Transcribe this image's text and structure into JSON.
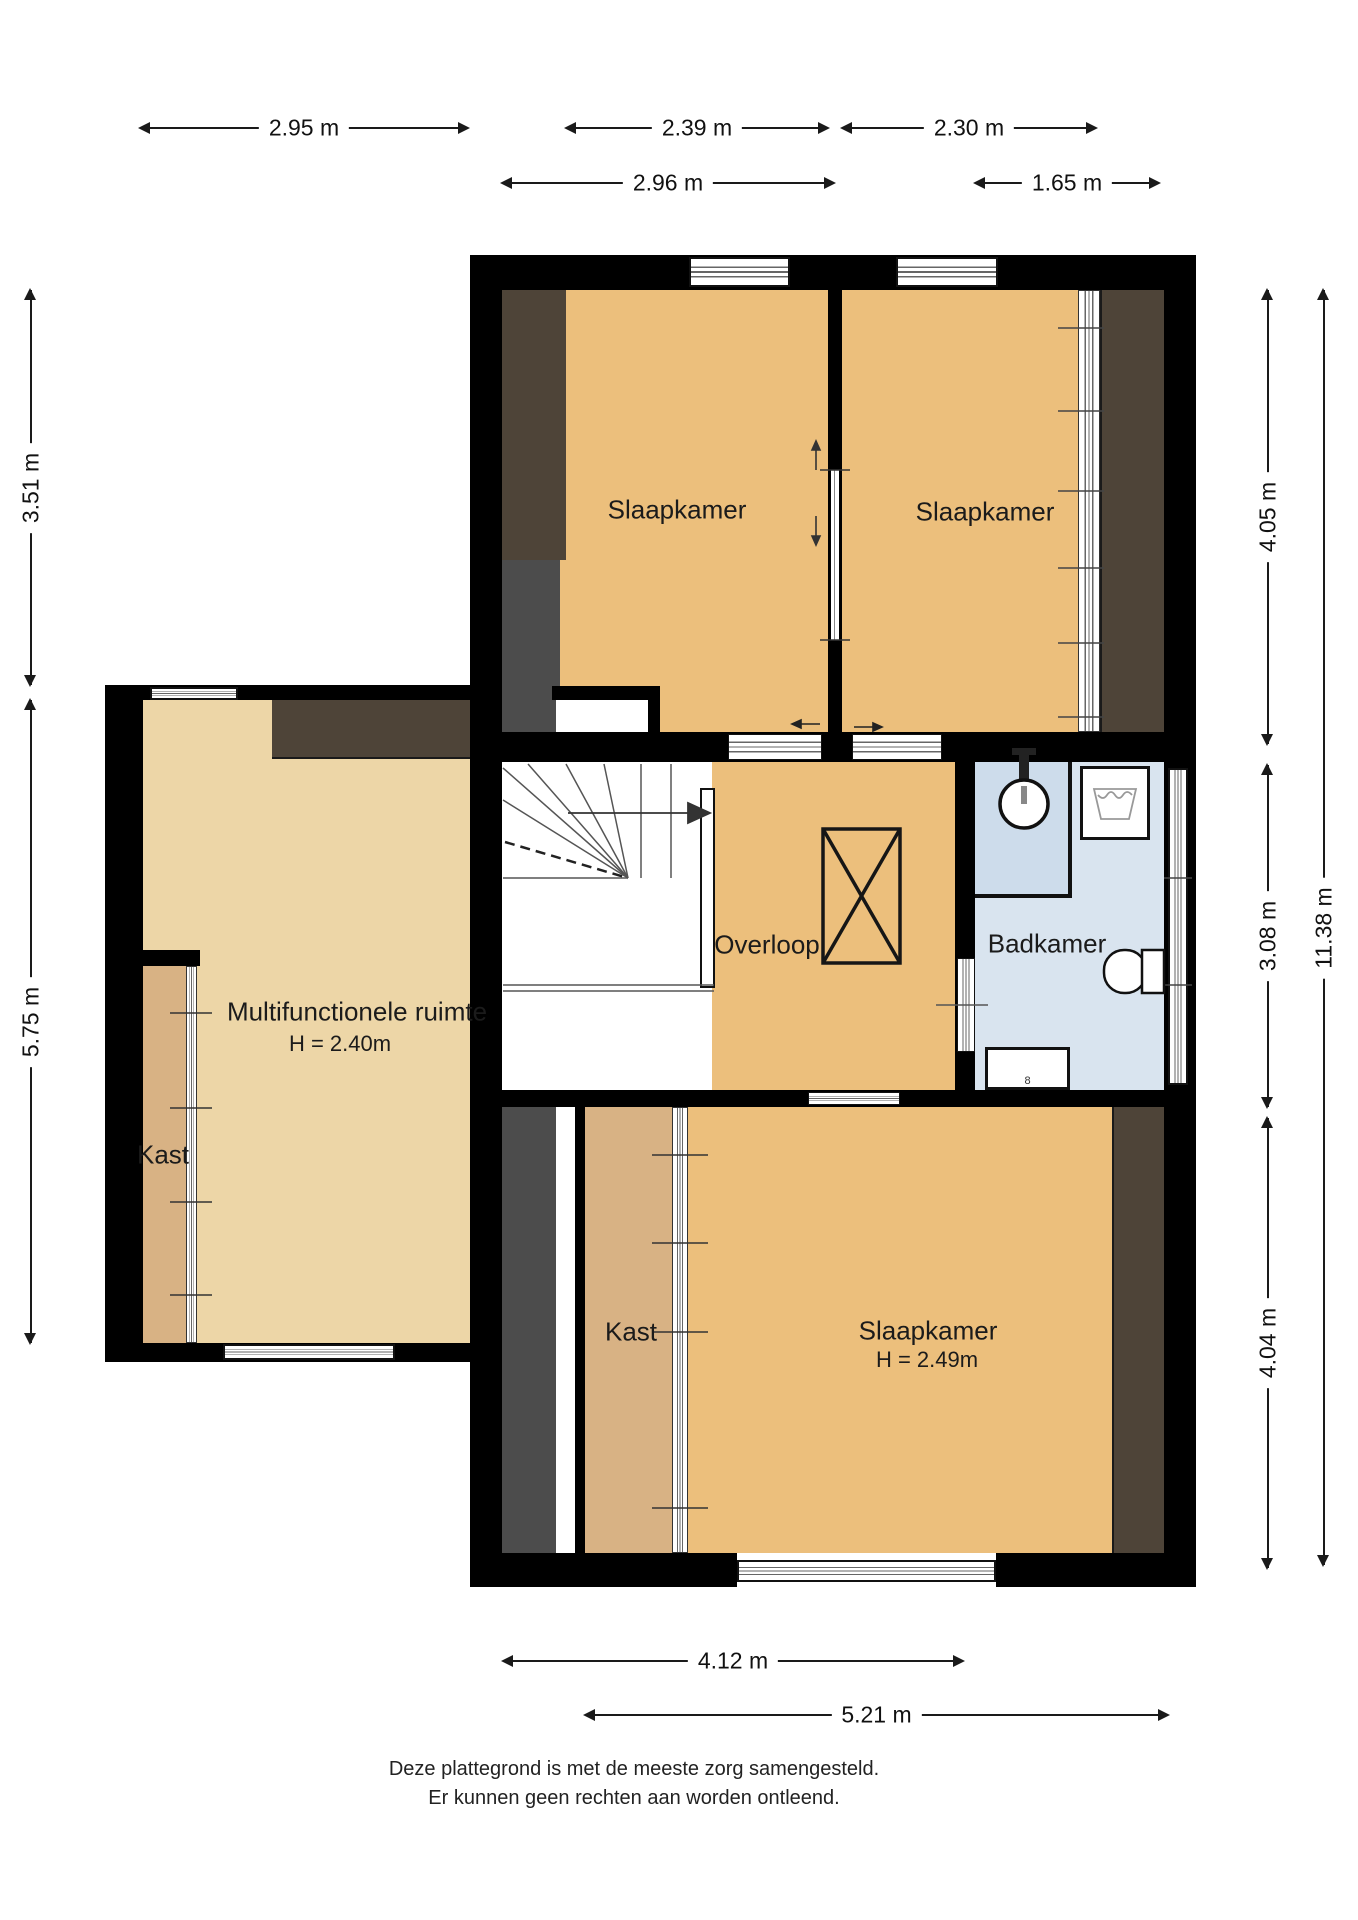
{
  "rooms": {
    "slaapkamer_links": {
      "label": "Slaapkamer"
    },
    "slaapkamer_rechts": {
      "label": "Slaapkamer"
    },
    "overloop": {
      "label": "Overloop"
    },
    "badkamer": {
      "label": "Badkamer"
    },
    "multifunctionele_ruimte": {
      "label": "Multifunctionele ruimte",
      "height": "H = 2.40m"
    },
    "kast_links": {
      "label": "Kast"
    },
    "kast_onder": {
      "label": "Kast"
    },
    "slaapkamer_onder": {
      "label": "Slaapkamer",
      "height": "H = 2.49m"
    }
  },
  "dimensions": {
    "w295": "2.95 m",
    "w239": "2.39 m",
    "w230": "2.30 m",
    "w296": "2.96 m",
    "w165": "1.65 m",
    "h351": "3.51 m",
    "h575": "5.75 m",
    "h405": "4.05 m",
    "h308": "3.08 m",
    "h404": "4.04 m",
    "h1138": "11.38 m",
    "w412": "4.12 m",
    "w521": "5.21 m"
  },
  "fixtures": {
    "radiator_symbol": "8"
  },
  "colors": {
    "floor_orange": "#ecbf7c",
    "floor_tan": "#edd6a7",
    "closet_tan": "#d8b284",
    "bath_blue": "#d9e4ef",
    "slope_brown": "#4e4438",
    "shaft_gray": "#4c4c4c",
    "wall_black": "#000000"
  },
  "footer": {
    "line1": "Deze plattegrond is met de meeste zorg samengesteld.",
    "line2": "Er kunnen geen rechten aan worden ontleend."
  }
}
